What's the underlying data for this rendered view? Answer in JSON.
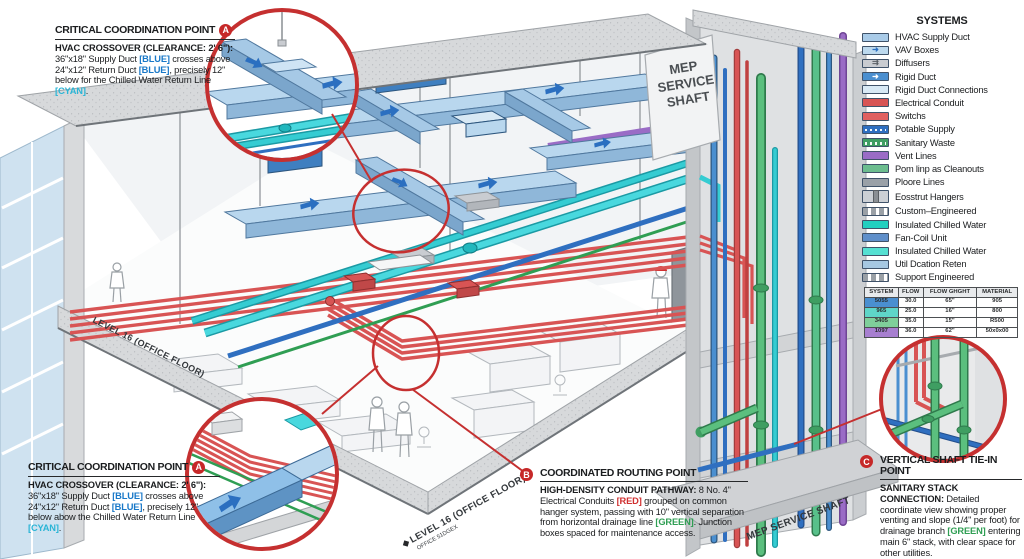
{
  "legend": {
    "title": "SYSTEMS",
    "items": [
      {
        "label": "HVAC Supply Duct",
        "color": "#a9cbe8",
        "style": "solid"
      },
      {
        "label": "VAV Boxes",
        "color": "#bcd9ee",
        "style": "arrow"
      },
      {
        "label": "Diffusers",
        "color": "#c9ccd1",
        "style": "arrows"
      },
      {
        "label": "Rigid Duct",
        "color": "#4a8fd0",
        "style": "arrow"
      },
      {
        "label": "Rigid Duct Connections",
        "color": "#d8e9f5",
        "style": "solid"
      },
      {
        "label": "Electrical Conduit",
        "color": "#d85454",
        "style": "solid"
      },
      {
        "label": "Switchs",
        "color": "#e06060",
        "style": "solid"
      },
      {
        "label": "Potable Supply",
        "color": "#2f6fc0",
        "style": "dotted"
      },
      {
        "label": "Sanitary Waste",
        "color": "#3f9e62",
        "style": "dotted"
      },
      {
        "label": "Vent Lines",
        "color": "#9a6cc6",
        "style": "solid"
      },
      {
        "label": "Pom linp as Cleanouts",
        "color": "#6cbd8f",
        "style": "solid"
      },
      {
        "label": "Ploore Lines",
        "color": "#9aa1a8",
        "style": "solid"
      },
      {
        "label": "Eosstrut Hangers",
        "color": "#ccd0d5",
        "style": "strut"
      },
      {
        "label": "Custom–Engineered",
        "color": "#9aa0a6",
        "style": "dashed"
      },
      {
        "label": "Insulated Chilled Water",
        "color": "#22cfc0",
        "style": "solid"
      },
      {
        "label": "Fan-Coil Unit",
        "color": "#5f8fca",
        "style": "solid"
      },
      {
        "label": "Insulated Chilled Water",
        "color": "#55e0d2",
        "style": "solid"
      },
      {
        "label": "Util Dcation Reten",
        "color": "#a6c8e2",
        "style": "solid"
      },
      {
        "label": "Support Engineered",
        "color": "#9aa0a6",
        "style": "dashed"
      }
    ]
  },
  "table": {
    "headers": [
      "SYSTEM",
      "FLOW",
      "FLOW GHGHT",
      "MATERIAL"
    ],
    "rows": [
      {
        "system": "5055",
        "color": "#4a8fd0",
        "flow": "30.0",
        "height": "65\"",
        "material": "905"
      },
      {
        "system": "965",
        "color": "#5fd6c8",
        "flow": "25.0",
        "height": "16\"",
        "material": "800"
      },
      {
        "system": "3405",
        "color": "#7fcf9a",
        "flow": "35.0",
        "height": "15\"",
        "material": "R500"
      },
      {
        "system": "1097",
        "color": "#a77fd0",
        "flow": "36.0",
        "height": "62\"",
        "material": "50x0x00"
      }
    ]
  },
  "callouts": {
    "a_top": {
      "badge": "A",
      "title": "CRITICAL COORDINATION POINT",
      "subtitle": "HVAC CROSSOVER (CLEARANCE: 2' 6\"):",
      "segments": [
        {
          "t": "36\"x18\" Supply Duct "
        },
        {
          "t": "[BLUE]",
          "c": "#1878c8"
        },
        {
          "t": " crosses above 24\"x12\" Return Duct "
        },
        {
          "t": "[BLUE]",
          "c": "#1878c8"
        },
        {
          "t": ", precisely 12\" below for the Chilled Water Return Line "
        },
        {
          "t": "[CYAN]",
          "c": "#2ab5d6"
        },
        {
          "t": "."
        }
      ]
    },
    "a_bottom": {
      "badge": "A",
      "title": "CRITICAL COORDINATION POINT",
      "subtitle": "HVAC CROSSOVER (CLEARANCE: 2' 6\"):",
      "segments": [
        {
          "t": "36\"x18\" Supply Duct "
        },
        {
          "t": "[BLUE]",
          "c": "#1878c8"
        },
        {
          "t": " crosses above 24\"x12\" Return Duct "
        },
        {
          "t": "[BLUE]",
          "c": "#1878c8"
        },
        {
          "t": ", precisely 12\" below abow the Chilled Water Return Line "
        },
        {
          "t": "[CYAN]",
          "c": "#2ab5d6"
        },
        {
          "t": "."
        }
      ]
    },
    "b": {
      "badge": "B",
      "title": "COORDINATED ROUTING POINT",
      "subtitle": "HIGH-DENSITY CONDUIT PATHWAY:",
      "segments": [
        {
          "t": " 8 No. 4\" Electrical Conduits "
        },
        {
          "t": "[RED]",
          "c": "#d03030"
        },
        {
          "t": " grouped on common hanger system, passing with 10\" vertical separation from horizontal drainage line "
        },
        {
          "t": "[GREEN]",
          "c": "#2f9e53"
        },
        {
          "t": ". Junction boxes spaced for maintenance access."
        }
      ]
    },
    "c": {
      "badge": "C",
      "title": "VERTICAL SHAFT TIE-IN POINT",
      "subtitle": "SANITARY STACK CONNECTION:",
      "segments": [
        {
          "t": " Detailed coordinate view showing proper venting and slope (1/4\" per foot) for drainage branch "
        },
        {
          "t": "[GREEN]",
          "c": "#2f9e53"
        },
        {
          "t": " entering main 6\" stack, with clear space for other utilities."
        }
      ]
    }
  },
  "labels": {
    "shaft_face_lines": [
      "MEP",
      "SERVICE",
      "SHAFT"
    ],
    "shaft_bottom": "MEP SERVICE SHAFT",
    "level_left": "LEVEL 16 (OFFICE FLOOR)",
    "level_bottom": "LEVEL 16 (OFFICE FLOOR)",
    "level_bottom_sub": "OFFICE 51DGEX"
  },
  "colors": {
    "annotation_red": "#c53030",
    "duct_blue": "#b9d7ee",
    "rigid_blue": "#4a8fd0",
    "chilled_cyan": "#35ccd2",
    "conduit_red": "#d85454",
    "sanitary_green": "#5bbf7e",
    "vent_purple": "#9a6cc6",
    "potable_blue": "#2f6fc0",
    "concrete_gray": "#d7d9db"
  }
}
